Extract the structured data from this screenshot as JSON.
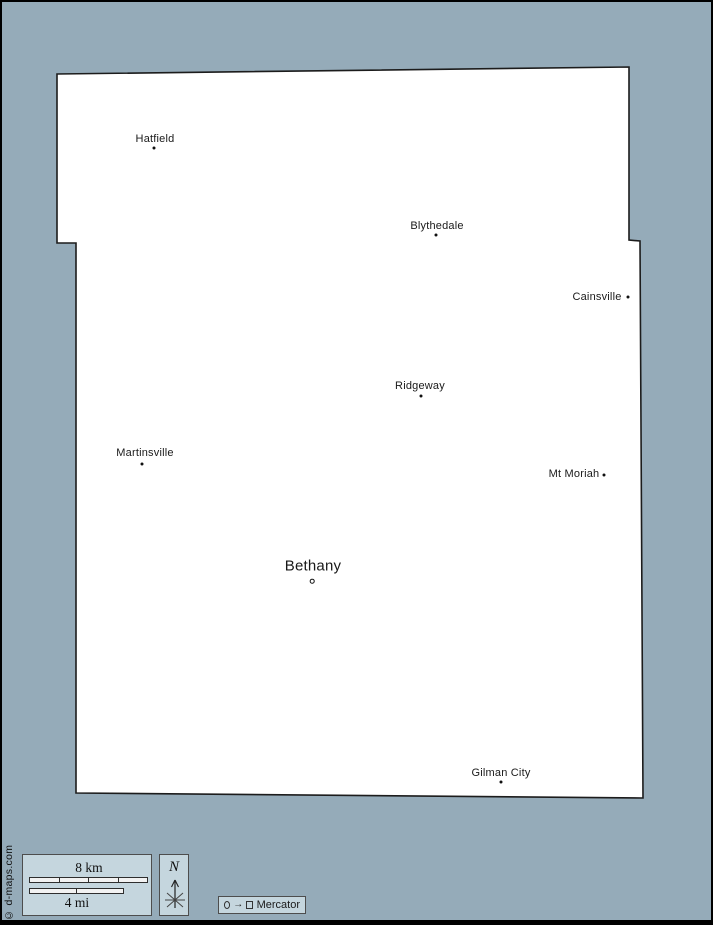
{
  "page": {
    "background_color": "#95abb9",
    "frame_color": "#000000"
  },
  "map": {
    "fill_color": "#ffffff",
    "outline_color": "#1c1c1c",
    "outline_points": "57,74 629,67 629,240 640,241 643,798 76,793 76,243 57,243",
    "towns": [
      {
        "name": "Hatfield",
        "type": "town",
        "label_x": 155,
        "label_y": 139,
        "dot_x": 154,
        "dot_y": 148
      },
      {
        "name": "Blythedale",
        "type": "town",
        "label_x": 437,
        "label_y": 226,
        "dot_x": 436,
        "dot_y": 235
      },
      {
        "name": "Cainsville",
        "type": "town",
        "label_x": 597,
        "label_y": 297,
        "dot_x": 628,
        "dot_y": 297
      },
      {
        "name": "Ridgeway",
        "type": "town",
        "label_x": 420,
        "label_y": 386,
        "dot_x": 421,
        "dot_y": 396
      },
      {
        "name": "Martinsville",
        "type": "town",
        "label_x": 145,
        "label_y": 453,
        "dot_x": 142,
        "dot_y": 464
      },
      {
        "name": "Mt Moriah",
        "type": "town",
        "label_x": 574,
        "label_y": 474,
        "dot_x": 604,
        "dot_y": 475
      },
      {
        "name": "Bethany",
        "type": "county-seat",
        "label_x": 313,
        "label_y": 566,
        "dot_x": 312,
        "dot_y": 581
      },
      {
        "name": "Gilman City",
        "type": "town",
        "label_x": 501,
        "label_y": 773,
        "dot_x": 501,
        "dot_y": 782
      }
    ]
  },
  "scale_bar": {
    "km_label": "8 km",
    "mi_label": "4 mi",
    "km_segments": 4,
    "mi_segments": 2
  },
  "compass": {
    "north_label": "N"
  },
  "projection_legend": {
    "label": "Mercator",
    "icons": [
      "circle-outline",
      "right-arrow",
      "square-outline"
    ]
  },
  "credit": {
    "text": "© d-maps.com"
  }
}
